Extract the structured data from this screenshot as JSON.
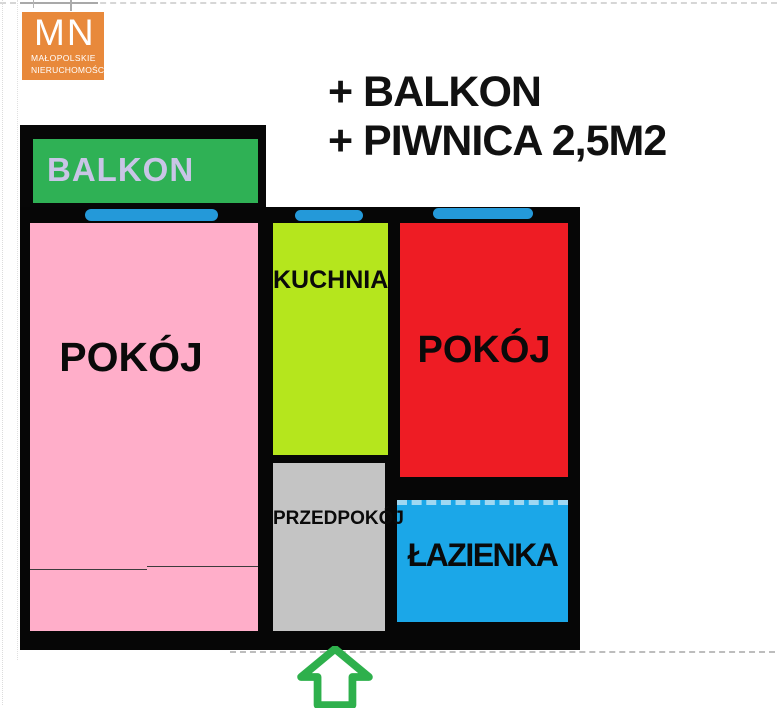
{
  "logo": {
    "initials": "MN",
    "line1": "MAŁOPOLSKIE",
    "line2": "NIERUCHOMOŚCI"
  },
  "annotations": {
    "line1": "+ BALKON",
    "line2": "+ PIWNICA 2,5M2"
  },
  "rooms": {
    "balkon": {
      "label": "BALKON"
    },
    "pokoj_left": {
      "label": "POKÓJ"
    },
    "kuchnia": {
      "label": "KUCHNIA"
    },
    "pokoj_right": {
      "label": "POKÓJ"
    },
    "przedpokoj": {
      "label": "PRZEDPOKÓJ"
    },
    "lazienka": {
      "label": "ŁAZIENKA"
    }
  },
  "icons": {
    "entrance_arrow": "up-block-arrow",
    "window_marker": "blue-window-bar"
  },
  "colors": {
    "logo_orange": "#e8893b",
    "balcony_green": "#2fb155",
    "balcony_text_lavender": "#c9c5e6",
    "room_pink": "#ffaec9",
    "kitchen_lime": "#b5e61d",
    "room_red": "#ee1c24",
    "hall_gray": "#c4c4c4",
    "bath_blue": "#1ba7e8",
    "window_blue": "#2499d9",
    "wall_black": "#060606",
    "arrow_green": "#2eb04c"
  }
}
